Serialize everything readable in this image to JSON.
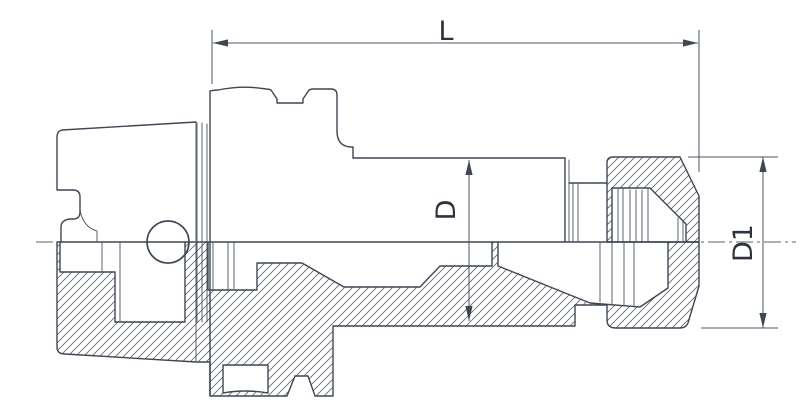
{
  "drawing": {
    "type": "technical-drawing",
    "subject": "collet-chuck-tool-holder-cross-section",
    "labels": {
      "length": "L",
      "body_diameter": "D",
      "nut_diameter": "D1"
    },
    "colors": {
      "background": "#ffffff",
      "outline": "#3f4754",
      "dimension_line": "#4a5462",
      "hatch": "#5b6573",
      "text": "#2c333f"
    }
  }
}
